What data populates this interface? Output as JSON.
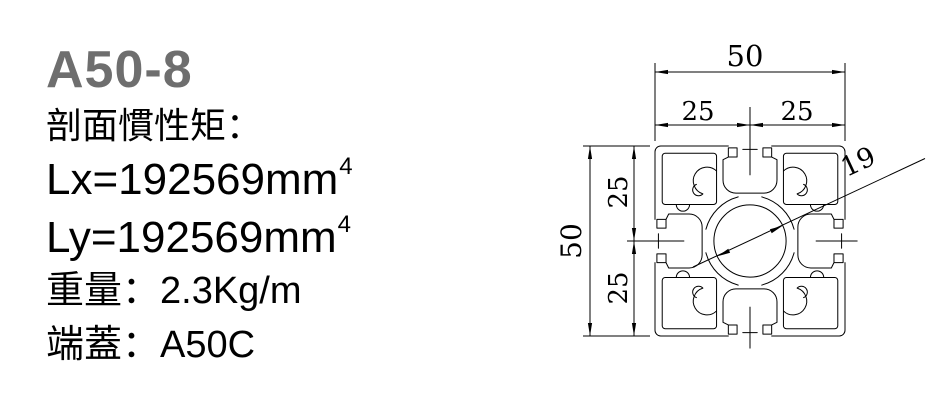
{
  "header": {
    "model": "A50-8",
    "title_color": "#6e6e6e"
  },
  "specs": {
    "inertia_heading": "剖面慣性矩：",
    "lx_value": "Lx=192569mm",
    "lx_exponent": "4",
    "ly_value": "Ly=192569mm",
    "ly_exponent": "4",
    "weight": "重量：2.3Kg/m",
    "end_cap": "端蓋：A50C"
  },
  "drawing": {
    "dimensions": {
      "overall_width": "50",
      "width_left_half": "25",
      "width_right_half": "25",
      "overall_height": "50",
      "height_top_half": "25",
      "height_bottom_half": "25",
      "center_hole_diameter": "19"
    }
  }
}
